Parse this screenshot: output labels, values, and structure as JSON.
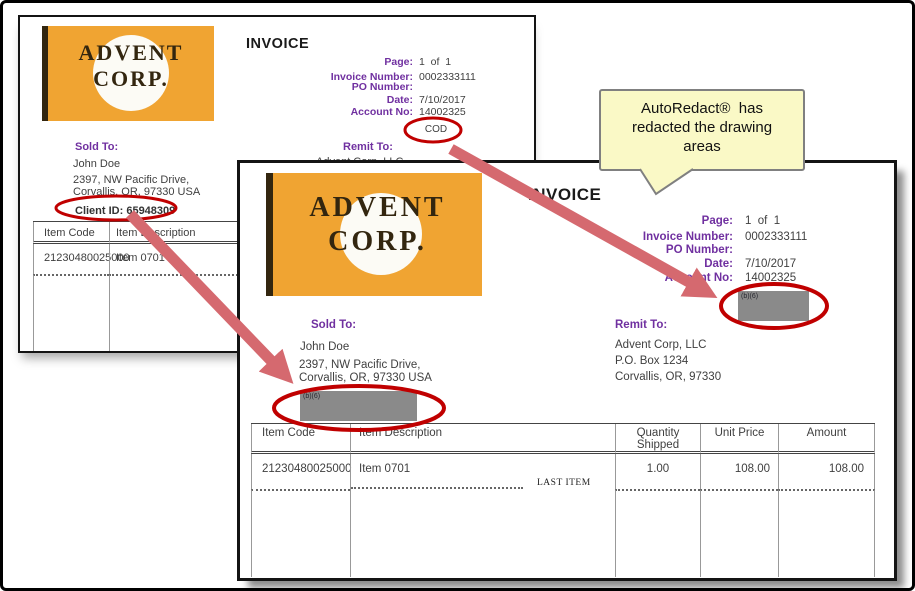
{
  "callout": {
    "text": "AutoRedact®  has\nredacted the drawing\nareas"
  },
  "annotation_colors": {
    "circle": "#C00000",
    "arrow": "#D5696F"
  },
  "back_invoice": {
    "logo_line1": "ADVENT",
    "logo_line2": "CORP.",
    "title": "INVOICE",
    "fields": [
      {
        "label": "Page:",
        "value": "1  of  1"
      },
      {
        "label": "Invoice Number:",
        "value": "0002333111"
      },
      {
        "label": "PO Number:",
        "value": ""
      },
      {
        "label": "Date:",
        "value": "7/10/2017"
      },
      {
        "label": "Account No:",
        "value": "14002325"
      }
    ],
    "terms": "COD",
    "sold_to_label": "Sold To:",
    "sold_to_name": "John Doe",
    "sold_to_address1": "2397, NW Pacific Drive,",
    "sold_to_address2": "Corvallis, OR, 97330 USA",
    "client_id": "Client ID: 65948309",
    "remit_to_label": "Remit To:",
    "remit_to_line1": "Advent Corp, LLC",
    "table_headers": [
      "Item Code",
      "Item Description"
    ],
    "row": [
      "21230480025000",
      "Item 0701"
    ]
  },
  "front_invoice": {
    "logo_line1": "ADVENT",
    "logo_line2": "CORP.",
    "title": "INVOICE",
    "fields": [
      {
        "label": "Page:",
        "value": "1  of  1"
      },
      {
        "label": "Invoice Number:",
        "value": "0002333111"
      },
      {
        "label": "PO Number:",
        "value": ""
      },
      {
        "label": "Date:",
        "value": "7/10/2017"
      },
      {
        "label": "Account No:",
        "value": "14002325"
      }
    ],
    "redaction_label": "(b)(6)",
    "sold_to_label": "Sold To:",
    "sold_to_name": "John Doe",
    "sold_to_address1": "2397, NW Pacific Drive,",
    "sold_to_address2": "Corvallis, OR, 97330 USA",
    "remit_to_label": "Remit To:",
    "remit_to_line1": "Advent Corp, LLC",
    "remit_to_line2": "P.O. Box 1234",
    "remit_to_line3": "Corvallis, OR, 97330",
    "table_headers": [
      "Item Code",
      "Item Description",
      "Quantity Shipped",
      "Unit Price",
      "Amount"
    ],
    "row": [
      "21230480025000",
      "Item 0701",
      "1.00",
      "108.00",
      "108.00"
    ],
    "last_item": "LAST ITEM"
  }
}
